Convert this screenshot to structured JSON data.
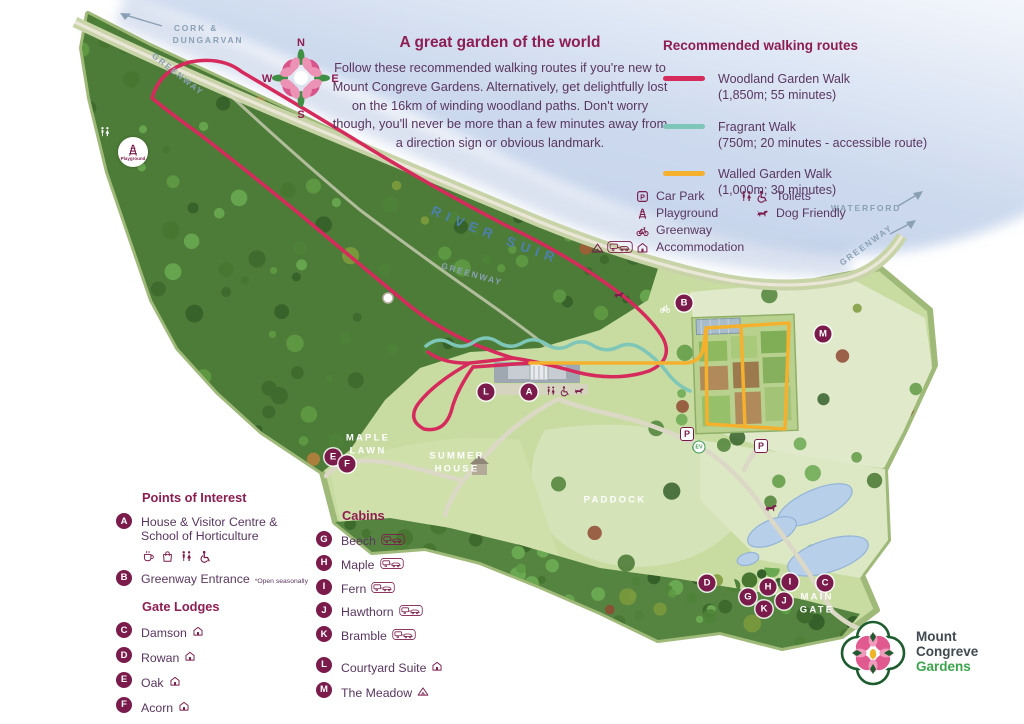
{
  "intro": {
    "title": "A great garden of the world",
    "body": "Follow these recommended walking routes if you're new to Mount Congreve Gardens. Alternatively, get delightfully lost on the 16km of winding woodland paths. Don't worry though, you'll never be more than a few minutes away from a direction sign or obvious landmark."
  },
  "routes_legend": {
    "title": "Recommended walking routes",
    "routes": [
      {
        "name": "Woodland Garden Walk",
        "detail": "(1,850m; 55 minutes)",
        "color": "#d62a5c"
      },
      {
        "name": "Fragrant Walk",
        "detail": "(750m; 20 minutes - accessible route)",
        "color": "#7ec6b8"
      },
      {
        "name": "Walled Garden Walk",
        "detail": "(1,000m; 30 minutes)",
        "color": "#f5b12d"
      }
    ]
  },
  "icons_legend": {
    "left": [
      {
        "icons": [
          "car-park"
        ],
        "label": "Car Park"
      },
      {
        "icons": [
          "playground"
        ],
        "label": "Playground"
      },
      {
        "icons": [
          "greenway"
        ],
        "label": "Greenway"
      },
      {
        "icons": [
          "tent",
          "caravan-badge",
          "lodge"
        ],
        "label": "Accommodation"
      }
    ],
    "right": [
      {
        "icons": [
          "toilets",
          "wheelchair"
        ],
        "label": "Toilets"
      },
      {
        "icons": [
          "dog"
        ],
        "label": "Dog Friendly"
      }
    ]
  },
  "poi": {
    "title": "Points of Interest",
    "items": [
      {
        "letter": "A",
        "label": "House & Visitor Centre &",
        "label2": "School of Horticulture",
        "icons": [
          "cafe",
          "shop",
          "toilets",
          "wheelchair"
        ]
      },
      {
        "letter": "B",
        "label": "Greenway Entrance",
        "note": "*Open seasonally"
      }
    ]
  },
  "gate_lodges": {
    "title": "Gate Lodges",
    "items": [
      {
        "letter": "C",
        "label": "Damson",
        "icon": "lodge"
      },
      {
        "letter": "D",
        "label": "Rowan",
        "icon": "lodge"
      },
      {
        "letter": "E",
        "label": "Oak",
        "icon": "lodge"
      },
      {
        "letter": "F",
        "label": "Acorn",
        "icon": "lodge"
      }
    ]
  },
  "cabins": {
    "title": "Cabins",
    "items": [
      {
        "letter": "G",
        "label": "Beech",
        "icon": "caravan-badge"
      },
      {
        "letter": "H",
        "label": "Maple",
        "icon": "caravan-badge"
      },
      {
        "letter": "I",
        "label": "Fern",
        "icon": "caravan-badge"
      },
      {
        "letter": "J",
        "label": "Hawthorn",
        "icon": "caravan-badge"
      },
      {
        "letter": "K",
        "label": "Bramble",
        "icon": "caravan-badge"
      }
    ],
    "extra": [
      {
        "letter": "L",
        "label": "Courtyard Suite",
        "icon": "lodge"
      },
      {
        "letter": "M",
        "label": "The Meadow",
        "icon": "tent"
      }
    ]
  },
  "map": {
    "river_label": "RIVER SUIR",
    "playground_badge_label": "Playground",
    "ev_label": "EV",
    "p_label": "P",
    "white_labels": [
      {
        "text": "MAPLE",
        "x": 368,
        "y": 438
      },
      {
        "text": "LAWN",
        "x": 368,
        "y": 451
      },
      {
        "text": "SUMMER",
        "x": 457,
        "y": 456
      },
      {
        "text": "HOUSE",
        "x": 457,
        "y": 469
      },
      {
        "text": "PADDOCK",
        "x": 615,
        "y": 500
      },
      {
        "text": "MAIN",
        "x": 817,
        "y": 597
      },
      {
        "text": "GATE",
        "x": 817,
        "y": 610
      }
    ],
    "way_labels": [
      {
        "text": "CORK &",
        "x": 196,
        "y": 28,
        "rot": 0
      },
      {
        "text": "DUNGARVAN",
        "x": 208,
        "y": 40,
        "rot": 0
      },
      {
        "text": "GREENWAY",
        "x": 178,
        "y": 74,
        "rot": 38
      },
      {
        "text": "GREENWAY",
        "x": 472,
        "y": 274,
        "rot": 16
      },
      {
        "text": "WATERFORD",
        "x": 866,
        "y": 208,
        "rot": 0
      },
      {
        "text": "GREENWAY",
        "x": 866,
        "y": 245,
        "rot": -36
      }
    ],
    "markers": [
      {
        "letter": "A",
        "x": 529,
        "y": 392
      },
      {
        "letter": "B",
        "x": 684,
        "y": 303
      },
      {
        "letter": "C",
        "x": 825,
        "y": 583
      },
      {
        "letter": "D",
        "x": 707,
        "y": 583
      },
      {
        "letter": "E",
        "x": 333,
        "y": 457
      },
      {
        "letter": "F",
        "x": 347,
        "y": 464
      },
      {
        "letter": "G",
        "x": 748,
        "y": 597
      },
      {
        "letter": "H",
        "x": 768,
        "y": 587
      },
      {
        "letter": "I",
        "x": 790,
        "y": 582
      },
      {
        "letter": "J",
        "x": 784,
        "y": 601
      },
      {
        "letter": "K",
        "x": 764,
        "y": 609
      },
      {
        "letter": "L",
        "x": 486,
        "y": 392
      },
      {
        "letter": "M",
        "x": 823,
        "y": 334
      }
    ],
    "p_badges": [
      {
        "x": 687,
        "y": 434
      },
      {
        "x": 761,
        "y": 446
      }
    ],
    "ev_badge": {
      "x": 699,
      "y": 447
    },
    "map_icons": [
      {
        "icon": "toilets",
        "x": 105,
        "y": 132,
        "color": "#ffffff",
        "size": 12
      },
      {
        "icon": "dog",
        "x": 619,
        "y": 295,
        "color": "#7b1b4b",
        "size": 12
      },
      {
        "icon": "greenway",
        "x": 665,
        "y": 308,
        "color": "#ffffff",
        "size": 11
      },
      {
        "icon": "dog",
        "x": 771,
        "y": 508,
        "color": "#7b1b4b",
        "size": 14
      },
      {
        "icon": "toilets",
        "x": 551,
        "y": 391,
        "color": "#7b1b4b",
        "size": 11
      },
      {
        "icon": "wheelchair",
        "x": 565,
        "y": 391,
        "color": "#7b1b4b",
        "size": 11
      },
      {
        "icon": "dog",
        "x": 579,
        "y": 391,
        "color": "#7b1b4b",
        "size": 11
      }
    ]
  },
  "compass": {
    "n": "N",
    "e": "E",
    "s": "S",
    "w": "W"
  },
  "logo": {
    "name1": "Mount",
    "name2": "Congreve",
    "name3": "Gardens"
  }
}
